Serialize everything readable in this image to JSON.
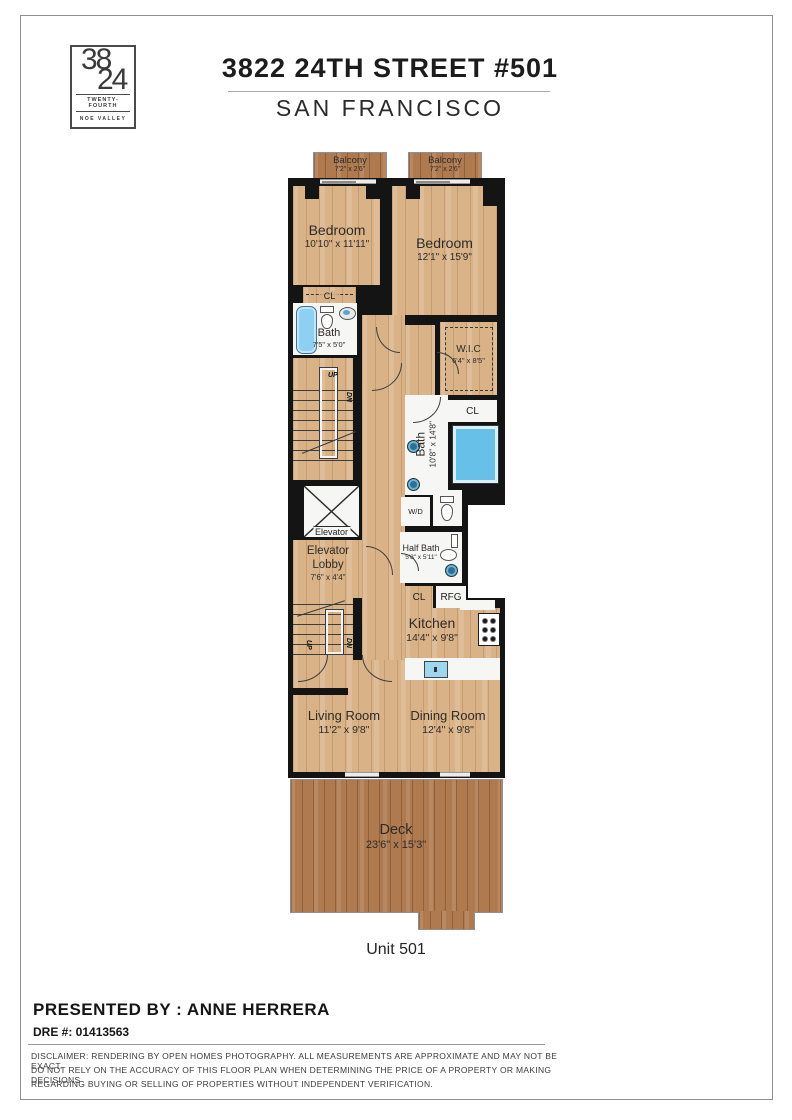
{
  "logo": {
    "top": "38",
    "bottom": "24",
    "line1": "TWENTY-FOURTH",
    "line2": "NOE VALLEY"
  },
  "header": {
    "title": "3822 24TH STREET #501",
    "subtitle": "SAN FRANCISCO"
  },
  "rooms": {
    "balcony_left": {
      "name": "Balcony",
      "dims": "7'2\" x 2'6\""
    },
    "balcony_right": {
      "name": "Balcony",
      "dims": "7'2\" x 2'6\""
    },
    "bedroom_left": {
      "name": "Bedroom",
      "dims": "10'10\" x 11'11\""
    },
    "bedroom_right": {
      "name": "Bedroom",
      "dims": "12'1\" x 15'9\""
    },
    "bath_top": {
      "name": "Bath",
      "dims": "7'5\" x 5'0\""
    },
    "wic": {
      "name": "W.I.C",
      "dims": "6'4\" x 8'5\""
    },
    "bath_main": {
      "name": "Bath",
      "dims": "10'8\" x 14'8\""
    },
    "elevator": {
      "name": "Elevator"
    },
    "elevator_lobby": {
      "name": "Elevator Lobby",
      "dims": "7'6\" x 4'4\""
    },
    "half_bath": {
      "name": "Half Bath",
      "dims": "5'8\" x 5'11\""
    },
    "kitchen": {
      "name": "Kitchen",
      "dims": "14'4\" x 9'8\""
    },
    "living": {
      "name": "Living Room",
      "dims": "11'2\" x 9'8\""
    },
    "dining": {
      "name": "Dining Room",
      "dims": "12'4\" x 9'8\""
    },
    "deck": {
      "name": "Deck",
      "dims": "23'6\" x 15'3\""
    }
  },
  "labels": {
    "cl": "CL",
    "wd": "W/D",
    "rfg": "RFG",
    "up": "UP",
    "dn": "DN",
    "unit": "Unit 501"
  },
  "footer": {
    "presented_by": "PRESENTED BY : ANNE HERRERA",
    "dre": "DRE #: 01413563",
    "disclaimer_line1": "DISCLAIMER: RENDERING BY OPEN HOMES PHOTOGRAPHY. ALL MEASUREMENTS ARE APPROXIMATE AND MAY NOT BE EXACT.",
    "disclaimer_line2": "DO NOT RELY ON THE ACCURACY OF THIS FLOOR PLAN WHEN DETERMINING THE PRICE OF A PROPERTY OR MAKING DECISIONS",
    "disclaimer_line3": "REGARDING BUYING OR SELLING OF PROPERTIES WITHOUT INDEPENDENT VERIFICATION."
  },
  "colors": {
    "wall": "#141414",
    "wood_light": "#d9b287",
    "wood_deck": "#b07a50",
    "fixture_blue": "#74c6ea",
    "room_white": "#f6f6f4"
  }
}
